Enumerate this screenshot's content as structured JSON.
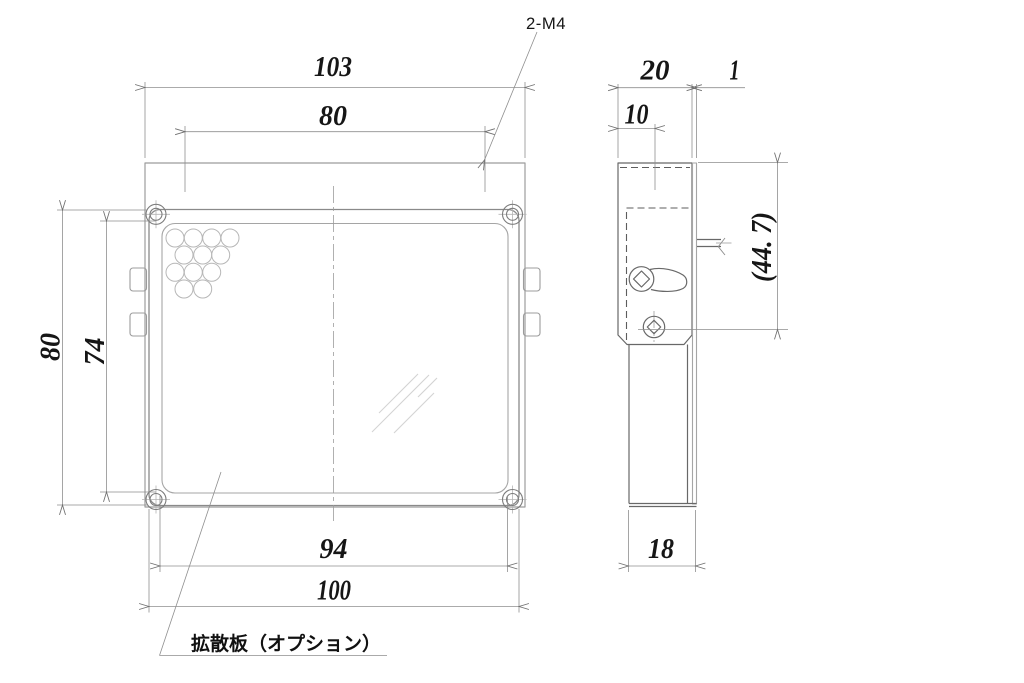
{
  "drawing_type": "mechanical-two-view",
  "callouts": {
    "tapped_holes": "2-M4",
    "diffuser_note": "拡散板（オプション）"
  },
  "dims": {
    "front_overall_width": "103",
    "front_hole_pitch": "80",
    "front_panel_height": "80",
    "front_window_height": "74",
    "front_window_width": "94",
    "front_panel_width": "100",
    "side_depth": "20",
    "side_plate_thickness": "1",
    "side_hole_offset": "10",
    "side_overall_height": "(44. 7)",
    "side_bracket_width": "18"
  },
  "colors": {
    "background": "#ffffff",
    "structure_line": "#9c9c9c",
    "dark_line": "#686868",
    "hidden_line": "#5d5d5d",
    "dimension_line": "#8f8f8f",
    "text": "#161616"
  }
}
